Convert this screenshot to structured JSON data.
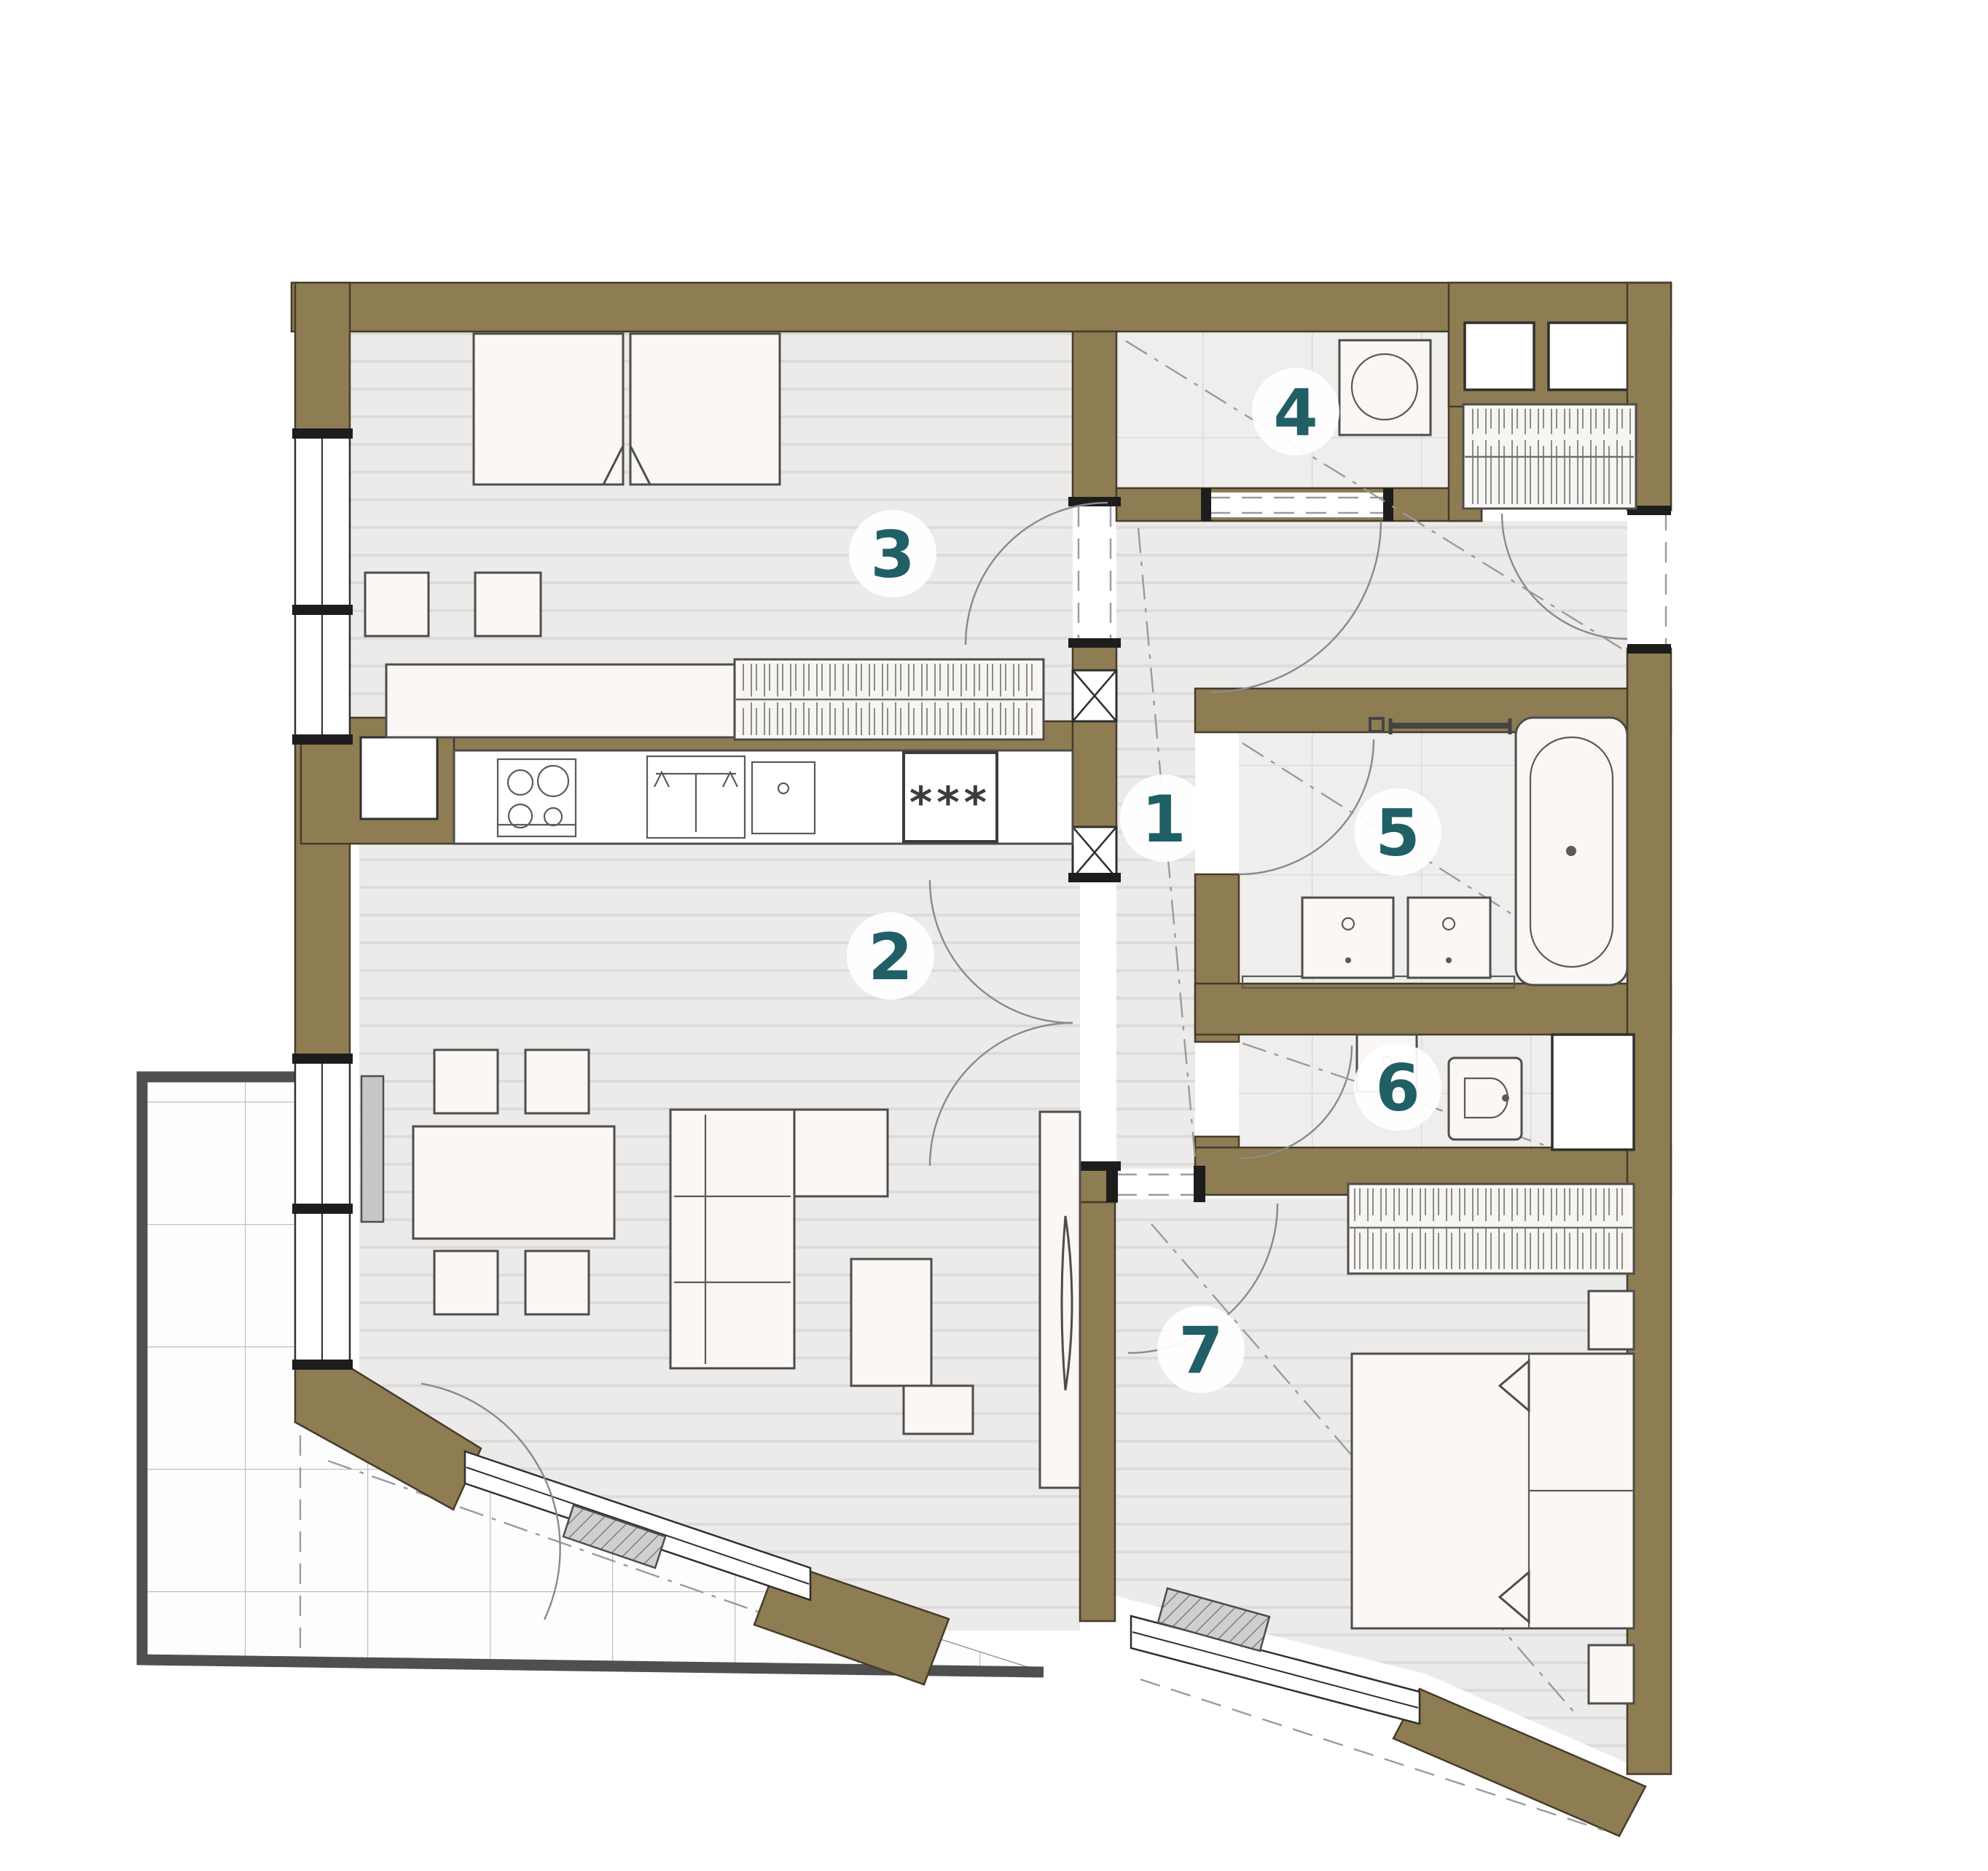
{
  "plan": {
    "rooms": [
      {
        "id": "room-1",
        "label": "1"
      },
      {
        "id": "room-2",
        "label": "2"
      },
      {
        "id": "room-3",
        "label": "3"
      },
      {
        "id": "room-4",
        "label": "4"
      },
      {
        "id": "room-5",
        "label": "5"
      },
      {
        "id": "room-6",
        "label": "6"
      },
      {
        "id": "room-7",
        "label": "7"
      }
    ],
    "symbols": {
      "freezer_stars": "***"
    },
    "colors": {
      "wall": "#8e7c52",
      "badge_number": "#215f66",
      "terrace_frame": "#4f4f4f",
      "furniture_stroke": "#4d4d4d",
      "wood_line": "#dddcdb",
      "tile_line": "#d8d8d8"
    }
  }
}
